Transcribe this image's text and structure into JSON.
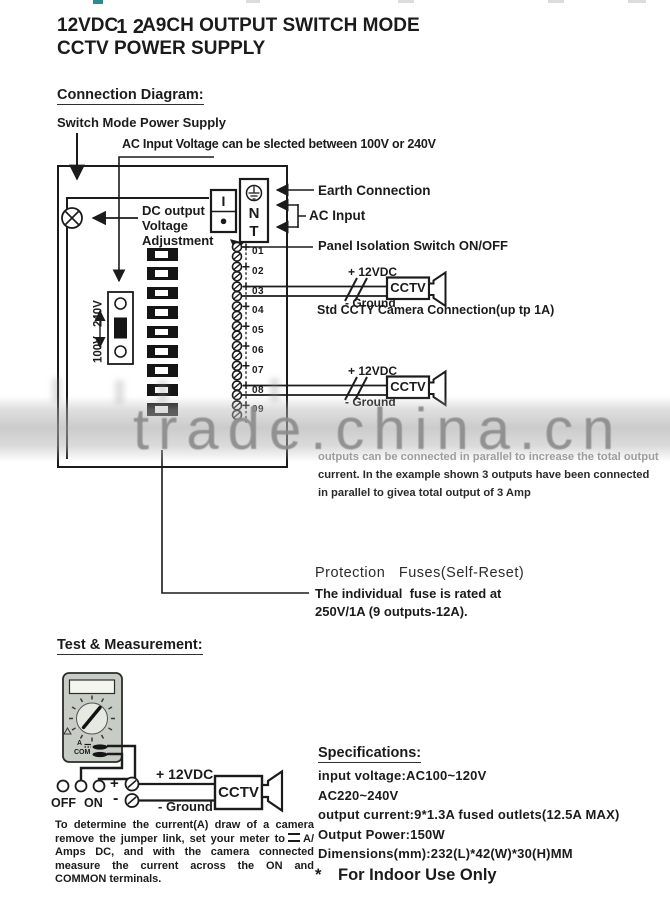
{
  "header": {
    "title_pre": "12VDC",
    "title_mid": "1 2",
    "title_post": "A9CH OUTPUT SWITCH MODE",
    "title_line2": "CCTV POWER SUPPLY"
  },
  "sections": {
    "connection": "Connection Diagram:",
    "test": "Test & Measurement:",
    "specs": "Specifications:"
  },
  "diagram": {
    "psu_label": "Switch Mode Power Supply",
    "ac_voltage_note": "AC Input Voltage can be slected between 100V or 240V",
    "dc_adjust": [
      "DC output",
      "Voltage",
      "Adjustment"
    ],
    "selector_top": "240V",
    "selector_bottom": "100V",
    "switch_on": "I",
    "switch_off": "●",
    "terminal_n": "N",
    "terminal_t": "T",
    "earth_label": "Earth Connection",
    "ac_input_label": "AC Input",
    "panel_switch_label": "Panel Isolation Switch ON/OFF",
    "camera_note": "Std CCTY Camera Connection(up tp 1A)",
    "wire_plus": "+ 12VDC",
    "wire_minus": "- Ground",
    "camera_label": "CCTV",
    "terminals": [
      "01",
      "02",
      "03",
      "04",
      "05",
      "06",
      "07",
      "08",
      "09"
    ],
    "parallel_note": [
      "outputs can be connected in parallel to increase the total output",
      "current. In the example shown 3 outputs have been connected",
      "in parallel to givea total output of 3 Amp"
    ],
    "fuse_title": "Protection   Fuses(Self-Reset)",
    "fuse_line1": "The individual  fuse is rated at",
    "fuse_line2": "250V/1A (9 outputs-12A)."
  },
  "watermark": {
    "text": "trade.china.cn",
    "color": "#8c8c8c"
  },
  "test": {
    "meter_a_label": "A",
    "meter_com_label": "COM",
    "off_label": "OFF",
    "on_label": "ON",
    "plus": "+",
    "minus": "-",
    "wire_plus": "+ 12VDC",
    "wire_minus": "- Ground",
    "camera_label": "CCTV",
    "note_pre": "To determine the current(A) draw of a camera remove the jumper link, set your meter to",
    "note_post": "A/ Amps DC, and with the camera connected measure the current across the ON and COMMON terminals."
  },
  "specs": {
    "lines": [
      "input voltage:AC100~120V",
      "AC220~240V",
      "output current:9*1.3A fused outlets(12.5A MAX)",
      "Output Power:150W",
      "Dimensions(mm):232(L)*42(W)*30(H)MM"
    ],
    "indoor_star": "*",
    "indoor_text": "For Indoor Use Only"
  }
}
